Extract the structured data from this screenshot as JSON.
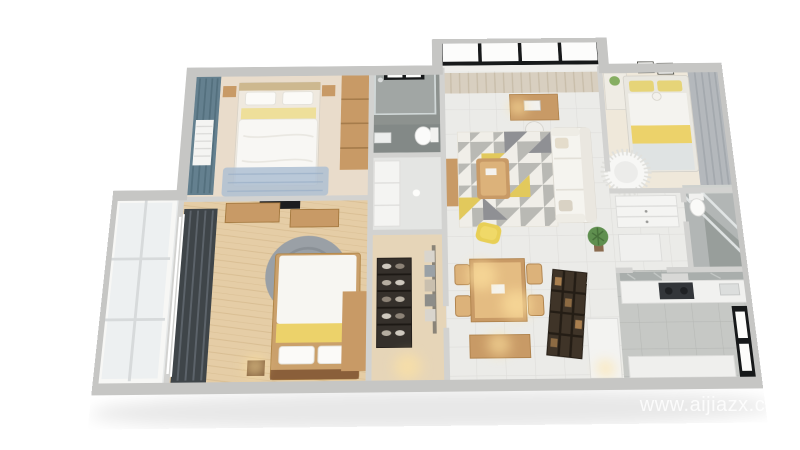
{
  "watermark": {
    "text": "www.aijiazx.com"
  },
  "palette": {
    "background": "#ffffff",
    "wall": "#d2d2d0",
    "wall_outer": "#c6c6c4",
    "wood_floor_light": "#e9dccb",
    "wood_floor_warm": "#e5cda6",
    "wood_floor_cloak": "#e6d5b8",
    "tile_light": "#ebebe8",
    "tile_kitchen": "#c6c8c5",
    "concrete": "#8d928f",
    "bath2_floor": "#b2b6b5",
    "wood_furniture": "#c89a66",
    "accent_yellow": "#e8cf56",
    "bed_stripe_yellow": "#ecd26a",
    "curtain_teal": "#64808f",
    "curtain_charcoal": "#3f4549",
    "curtain_gray": "#b4b8bc",
    "curtain_beige": "#d8cfc0",
    "sofa_white": "#f5f4ef",
    "rug_blue": "#aebfd2",
    "rug_round_gray": "#9aa0a6",
    "plant_green": "#5f8f4f",
    "window_frame_dark": "#17191a",
    "glow_warm": "#ffe3a0",
    "watermark_color": "rgba(255,255,255,0.82)"
  }
}
